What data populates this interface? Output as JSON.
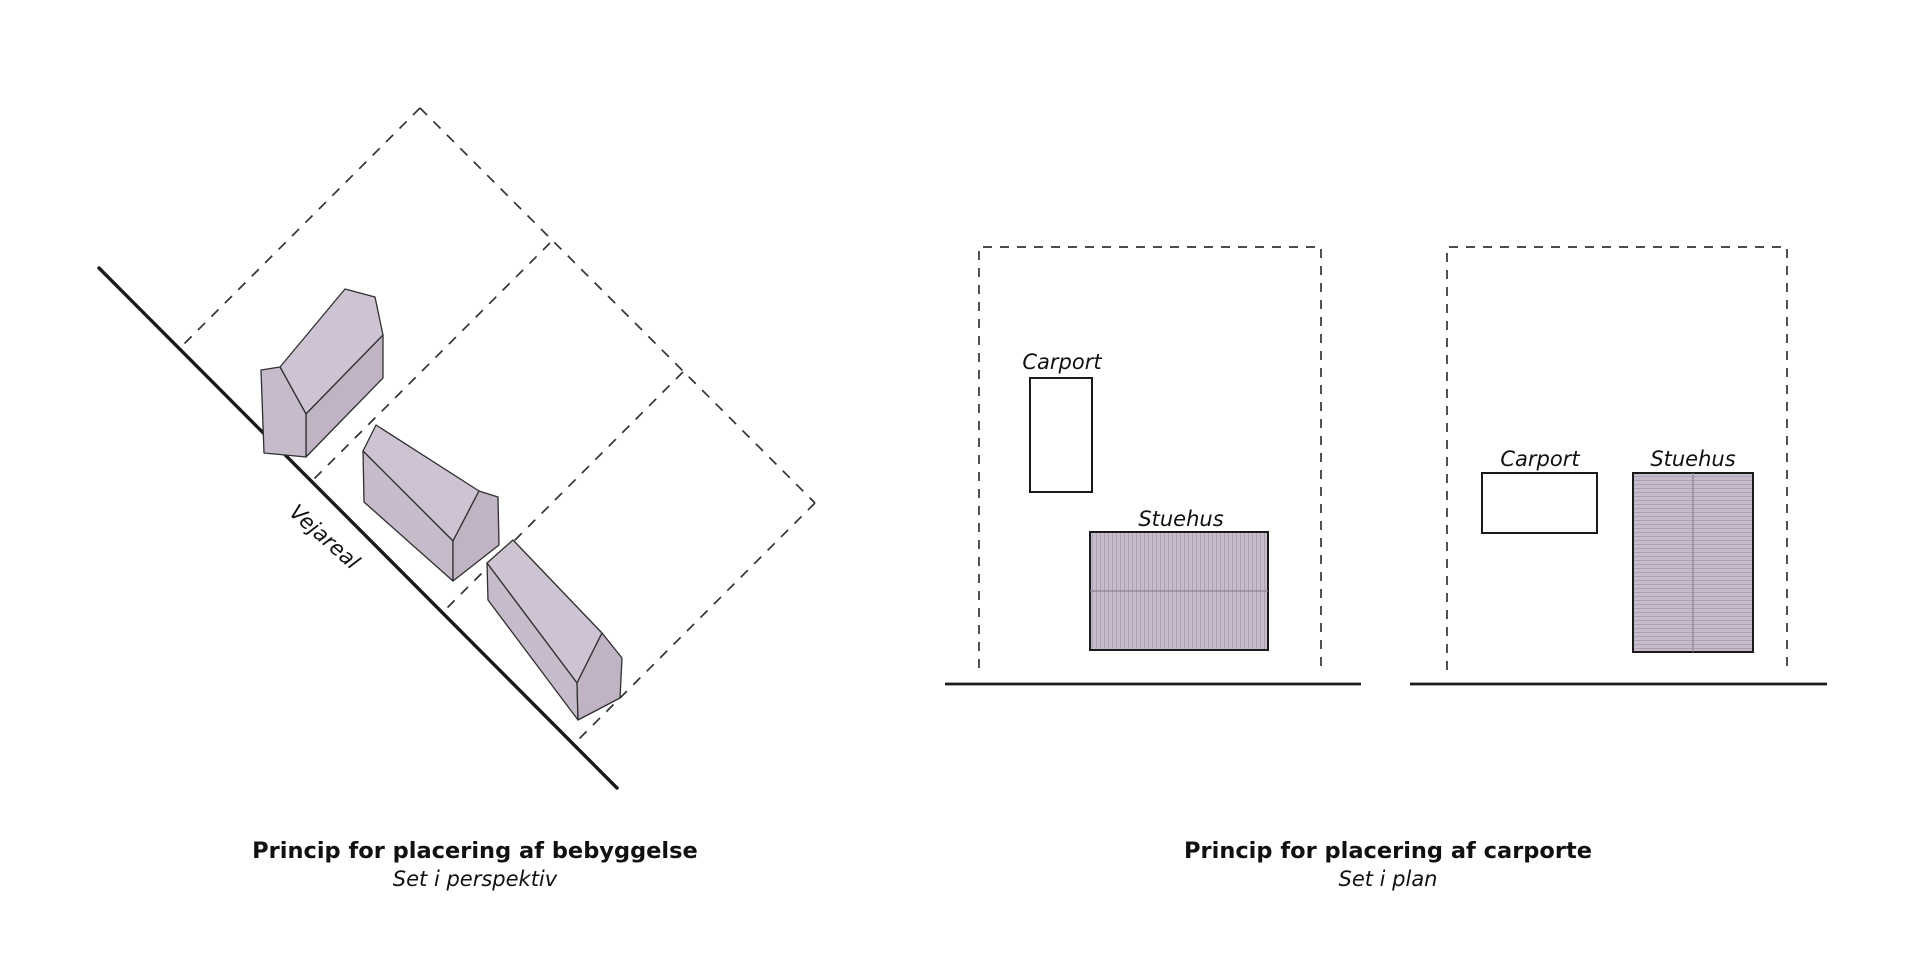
{
  "left_figure": {
    "road_label": "Vejareal",
    "caption_title": "Princip for placering af bebyggelse",
    "caption_subtitle": "Set i perspektiv"
  },
  "right_figure": {
    "plan1": {
      "carport_label": "Carport",
      "stuehus_label": "Stuehus"
    },
    "plan2": {
      "carport_label": "Carport",
      "stuehus_label": "Stuehus"
    },
    "caption_title": "Princip for placering af carporte",
    "caption_subtitle": "Set i plan"
  },
  "colors": {
    "background": "#ffffff",
    "line": "#1a1a1a",
    "dash": "#333333",
    "house_fill": "#c6bbca",
    "house_roof": "#cdc3d3",
    "house_side": "#c0b4c4",
    "hatch_line": "#aba0b6",
    "ridge_line": "#8b8196",
    "text": "#111111"
  }
}
